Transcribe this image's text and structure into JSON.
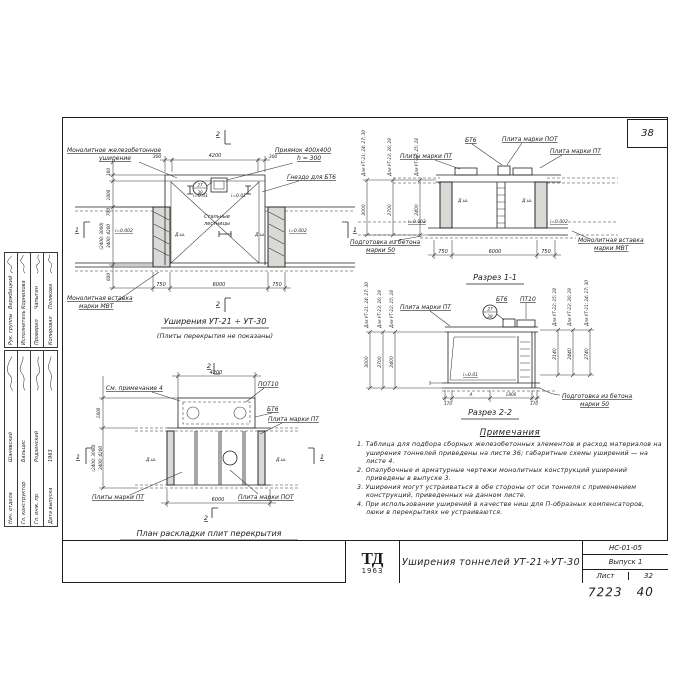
{
  "sheet": {
    "corner_number": "38",
    "hand_note_1": "7223",
    "hand_note_2": "40"
  },
  "plan_top": {
    "marker_1": "1",
    "marker_2": "2",
    "label_widening": "Монолитное железобетонное",
    "label_widening2": "уширение",
    "label_pit": "Приямок 400x400",
    "label_pit2": "h = 300",
    "label_socket": "Гнездо для БТ6",
    "label_ladders": "Стальные",
    "label_ladders2": "лестницы",
    "label_insert": "Монолитная вставка",
    "label_insert2": "марки МВТ",
    "detail_top": "27",
    "detail_bottom": "39",
    "dim_top_left": "300",
    "dim_top_mid": "4200",
    "dim_top_right": "300",
    "dim_bot_left": "750",
    "dim_bot_mid": "6000",
    "dim_bot_right": "750",
    "dim_side_1": "180",
    "dim_side_2": "1800",
    "dim_side_3": "700",
    "dim_side_4": "(2400; 3000)",
    "dim_side_4b": "3400; 4200",
    "dim_side_5": "600",
    "slope_a": "i=0.01",
    "slope_b": "i=0.01",
    "slope_c": "i=0.002",
    "slope_d": "i=0.002",
    "dsh": "Д.ш.",
    "title": "Уширения УТ-21 ÷ УТ-30",
    "subtitle": "(Плиты перекрытия не показаны)"
  },
  "section1": {
    "label_pt_left": "Плиты марки ПТ",
    "label_bt6": "БТ6",
    "label_pot": "Плита марки ПОТ",
    "label_pt_right": "Плита марки ПТ",
    "label_insert": "Монолитная вставка",
    "label_insert2": "марки МВТ",
    "label_prep": "Подготовка из бетона",
    "label_prep2": "марки 50",
    "dsh": "Д.ш.",
    "slope": "i=0.002",
    "dim_left": "750",
    "dim_mid": "6000",
    "dim_right": "750",
    "h1_label": "Для УТ-21; 24; 27; 30",
    "h1": "3000",
    "h2_label": "Для УТ-23; 26; 29",
    "h2": "2700",
    "h3_label": "Для УТ-22; 25; 28",
    "h3": "2400",
    "title": "Разрез 1-1"
  },
  "section2": {
    "label_pt": "Плита марки ПТ",
    "label_bt6": "БТ6",
    "label_pt10": "ПТ10",
    "detail_top": "27",
    "detail_bottom": "39",
    "label_prep": "Подготовка из бетона",
    "label_prep2": "марки 50",
    "slope": "i=0.01",
    "dim_1": "170",
    "dim_2": "А",
    "dim_3": "1800",
    "dim_4": "170",
    "hl1_label": "Для УТ-21; 24; 27; 30",
    "hl1": "3000",
    "hl2_label": "Для УТ-23; 26; 29",
    "hl2": "2700",
    "hl3_label": "Для УТ-22; 25; 28",
    "hl3": "2400",
    "hr1_label": "Для УТ-22; 25; 28",
    "hr1": "2140",
    "hr2_label": "Для УТ-23; 26; 29",
    "hr2": "2440",
    "hr3_label": "Для УТ-21; 24; 27; 30",
    "hr3": "2740",
    "title": "Разрез 2-2"
  },
  "plan_bottom": {
    "note_ref": "См. примечание 4",
    "label_pot10": "ПОТ10",
    "label_bt6": "БТ6",
    "label_pt": "Плита марки ПТ",
    "label_pt_pl": "Плиты марки ПТ",
    "label_pot": "Плита марки ПОТ",
    "dsh": "Д.ш.",
    "dim_top": "4200",
    "dim_bot": "6000",
    "dim_side_1": "1800",
    "dim_side_2": "(2400; 3000)",
    "dim_side_2b": "3400; 4200",
    "marker_1": "1",
    "marker_2": "2",
    "title": "План раскладки плит перекрытия"
  },
  "notes": {
    "title": "Примечания",
    "items": [
      "1. Таблица для подбора сборных железобетонных элементов и расход материалов на уширения тоннелей приведены на листе 36; габаритные схемы уширений — на листе 4.",
      "2. Опалубочные и арматурные чертежи монолитных конструкций уширений приведены в выпуске 3.",
      "3. Уширения могут устраиваться в обе стороны от оси тоннеля с применением конструкций, приведенных на данном листе.",
      "4. При использовании уширений в качестве ниш для П-образных компенсаторов, люки в перекрытиях не устраиваются."
    ]
  },
  "titleblock": {
    "logo": "ТД",
    "logo_year": "1963",
    "title": "Уширения тоннелей УТ-21÷УТ-30",
    "code": "НС-01-05",
    "issue": "Выпуск 1",
    "sheet_label": "Лист",
    "sheet_number": "32"
  },
  "stamp": {
    "top_rows": [
      {
        "role": "Рук. группы",
        "name": "Вержбицкий"
      },
      {
        "role": "Исполнитель",
        "name": "Корнилова"
      },
      {
        "role": "Проверил",
        "name": "Чапыгин"
      },
      {
        "role": "Копировал",
        "name": "Полякова"
      }
    ],
    "bottom_rows": [
      {
        "role": "Нач. отдела",
        "name": "Шанявский"
      },
      {
        "role": "Гл. конструктор",
        "name": "Бальцис"
      },
      {
        "role": "Гл. инж. пр.",
        "name": "Родзинский"
      },
      {
        "role": "Дата выпуска",
        "name": "1963"
      }
    ]
  }
}
